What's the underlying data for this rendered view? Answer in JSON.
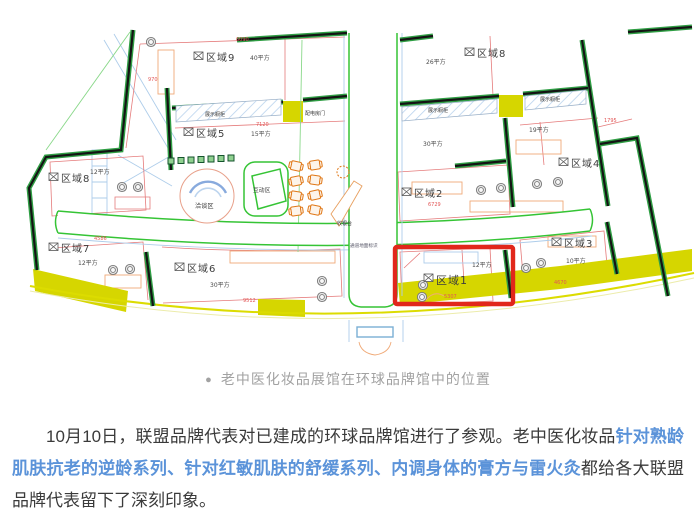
{
  "caption": {
    "bullet": "●",
    "text": "老中医化妆品展馆在环球品牌馆中的位置"
  },
  "paragraph": {
    "part1": "10月10日，联盟品牌代表对已建成的环球品牌馆进行了参观。老中医化妆品",
    "highlight": "针对熟龄肌肤抗老的逆龄系列、针对红敏肌肤的舒缓系列、内调身体的膏方与雷火灸",
    "part2": "都给各大联盟品牌代表留下了深刻印象。",
    "highlight_color": "#5b93d9"
  },
  "plan": {
    "zones": [
      {
        "name": "区域9",
        "area": "40平方"
      },
      {
        "name": "区域8",
        "area": "26平方"
      },
      {
        "name": "区域5",
        "area": "15平方"
      },
      {
        "name": "区域4",
        "area": "19平方"
      },
      {
        "name": "区域2",
        "area": "30平方"
      },
      {
        "name": "区域8",
        "area": "12平方"
      },
      {
        "name": "区域7",
        "area": "12平方"
      },
      {
        "name": "区域6",
        "area": "30平方"
      },
      {
        "name": "区域1",
        "area": "12平方"
      },
      {
        "name": "区域3",
        "area": "10平方"
      }
    ],
    "labels": {
      "display_case": "展示橱柜",
      "power_door": "配电房门",
      "talk_area": "洽谈区",
      "interact_area": "互动区",
      "cashier": "收银台",
      "corridor_sign": "通道地面标识"
    },
    "dims": {
      "d1": "6090",
      "d2": "970",
      "d3": "7120",
      "d4": "6729",
      "d5": "1795",
      "d6": "4586",
      "d7": "5307",
      "d8": "4670",
      "d9": "9512"
    },
    "highlight": {
      "zone": "区域1",
      "color": "#e1271b"
    }
  }
}
